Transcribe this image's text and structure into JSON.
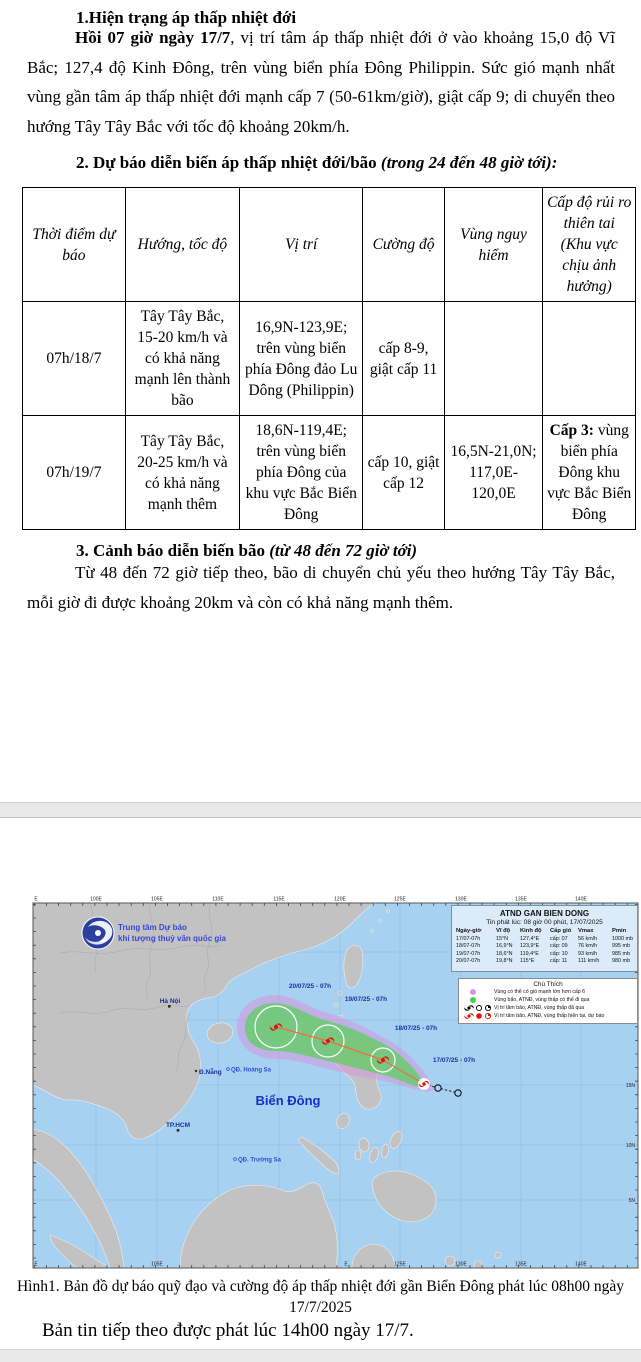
{
  "document": {
    "section1": {
      "heading": "1.Hiện trạng áp thấp nhiệt đới",
      "lead": "Hồi 07 giờ ngày 17/7",
      "body": ", vị trí tâm áp thấp nhiệt đới ở vào khoảng 15,0 độ Vĩ Bắc; 127,4 độ Kinh Đông, trên vùng biển phía Đông Philippin. Sức gió mạnh nhất vùng gần tâm áp thấp nhiệt đới mạnh cấp 7 (50-61km/giờ), giật cấp 9; di chuyển theo hướng Tây Tây Bắc với tốc độ khoảng 20km/h."
    },
    "section2": {
      "heading_bold": "2. Dự báo diễn biến áp thấp nhiệt đới/bão ",
      "heading_italic": "(trong 24 đến 48 giờ tới):"
    },
    "forecast_table": {
      "headers": [
        "Thời điểm dự báo",
        "Hướng, tốc độ",
        "Vị trí",
        "Cường độ",
        "Vùng nguy hiểm",
        "Cấp độ rủi ro thiên tai (Khu vực chịu ảnh hưởng)"
      ],
      "rows": [
        {
          "time": "07h/18/7",
          "direction": "Tây Tây Bắc, 15-20 km/h và có khả năng mạnh lên thành bão",
          "position": "16,9N-123,9E; trên vùng biển phía Đông đảo Lu Dông (Philippin)",
          "intensity": "cấp 8-9, giật cấp 11",
          "danger_zone": "",
          "risk_label": "",
          "risk_text": ""
        },
        {
          "time": "07h/19/7",
          "direction": "Tây Tây Bắc, 20-25 km/h và có khả năng mạnh thêm",
          "position": "18,6N-119,4E; trên vùng biển phía Đông của khu vực Bắc Biển Đông",
          "intensity": "cấp 10, giật cấp 12",
          "danger_zone": "16,5N-21,0N; 117,0E-120,0E",
          "risk_label": "Cấp 3:",
          "risk_text": " vùng biển phía Đông khu vực Bắc Biển Đông"
        }
      ]
    },
    "section3": {
      "heading_bold": "3. Cảnh báo diễn biến bão ",
      "heading_italic": "(từ 48 đến 72 giờ tới)",
      "body": "Từ 48 đến 72 giờ tiếp theo, bão di chuyển chủ yếu theo hướng Tây Tây Bắc, mỗi giờ đi được khoảng 20km và còn có khả năng mạnh thêm."
    },
    "figure_caption_line1": "Hình1. Bản đồ dự báo quỹ đạo và cường độ áp thấp nhiệt đới gần Biển Đông phát lúc 08h00 ngày",
    "figure_caption_line2": "17/7/2025",
    "footer_note": "Bản tin tiếp theo được phát lúc 14h00 ngày 17/7."
  },
  "map": {
    "agency_line1": "Trung tâm Dự báo",
    "agency_line2": "khí tượng thuỷ văn quốc gia",
    "info_box": {
      "title": "ATND GAN BIEN DONG",
      "issued": "Tin phát lúc: 08 giờ 00 phút, 17/07/2025",
      "headers": [
        "Ngày-giờ",
        "Vĩ độ",
        "Kinh độ",
        "Cấp gió",
        "Vmax",
        "Pmin"
      ],
      "rows": [
        [
          "17/07-07h",
          "15°N",
          "127,4°E",
          "cấp: 07",
          "56 km/h",
          "1000 mb"
        ],
        [
          "18/07-07h",
          "16,9°N",
          "123,9°E",
          "cấp: 09",
          "76 km/h",
          "995 mb"
        ],
        [
          "19/07-07h",
          "18,6°N",
          "119,4°E",
          "cấp: 10",
          "93 km/h",
          "985 mb"
        ],
        [
          "20/07-07h",
          "19,8°N",
          "115°E",
          "cấp: 11",
          "111 km/h",
          "980 mb"
        ]
      ]
    },
    "legend": {
      "title": "Chú Thích",
      "item1": "Vùng có thể có gió mạnh lớn hơn cấp 6",
      "item2": "Vùng bão, ATNĐ, vùng thấp có thể đi qua",
      "item3": "Vị trí tâm bão, ATNĐ, vùng thấp đã qua",
      "item4": "Vị trí tâm bão, ATNĐ, vùng thấp hiện tại, dự báo"
    },
    "track_labels": [
      "20/07/25 - 07h",
      "19/07/25 - 07h",
      "18/07/25 - 07h",
      "17/07/25 - 07h"
    ],
    "places": {
      "hanoi": "Hà Nội",
      "danang": "Đ.Nẵng",
      "hcm": "TP.HCM",
      "hoangsa": "QĐ. Hoàng Sa",
      "truongsa": "QĐ. Trường Sa",
      "biendong": "Biển Đông"
    },
    "lat_labels": [
      "25N",
      "20N",
      "15N",
      "10N",
      "5N"
    ],
    "lon_labels_top": [
      "E",
      "100E",
      "105E",
      "110E",
      "115E",
      "120E",
      "125E",
      "130E",
      "135E",
      "140E"
    ],
    "lon_labels_bottom": [
      "E",
      "105E",
      "E",
      "125E",
      "130E",
      "135E",
      "140E"
    ],
    "colors": {
      "sea": "#a7d1f1",
      "land": "#c2c2c2",
      "cone_outer": "#d98fe0",
      "cone_inner": "#5ed05e",
      "storm_symbol": "#e01010",
      "legend_dot1": "#d993e8",
      "legend_dot2": "#44d344"
    }
  }
}
